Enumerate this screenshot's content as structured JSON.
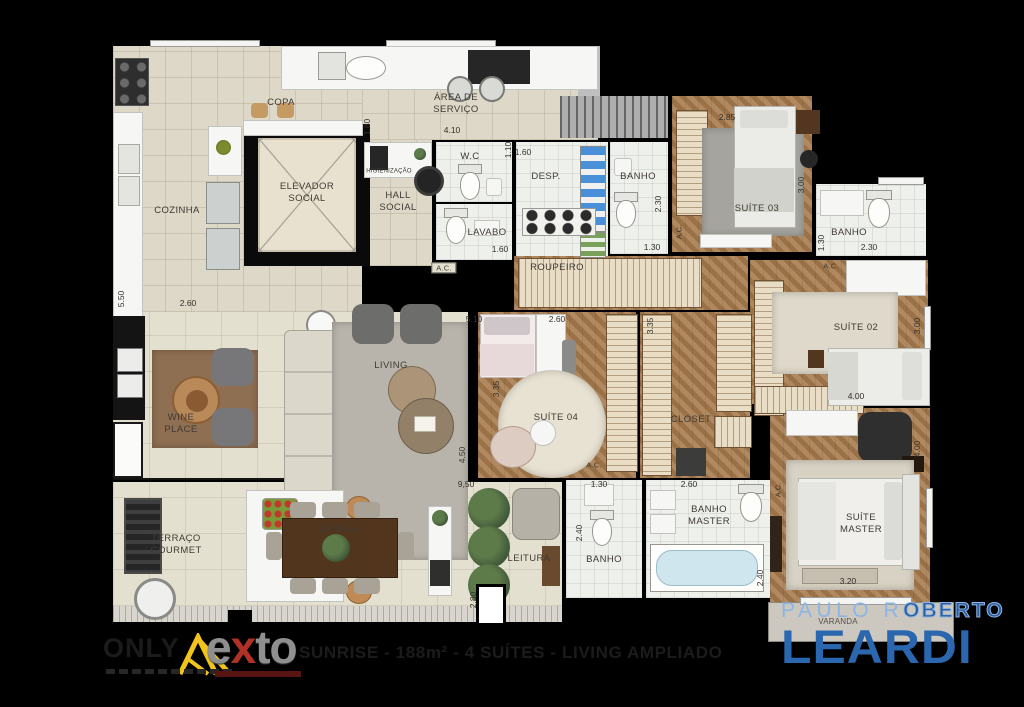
{
  "plan": {
    "rooms": {
      "copa": "COPA",
      "cozinha": "COZINHA",
      "area_servico": "ÁREA DE\nSERVIÇO",
      "elevador": "ELEVADOR\nSOCIAL",
      "higienizacao": "HIGIENIZAÇÃO",
      "hall": "HALL\nSOCIAL",
      "wc": "W.C",
      "lavabo": "LAVABO",
      "desp": "DESP.",
      "banho": "BANHO",
      "suite03": "SUÍTE 03",
      "roupeiro": "ROUPEIRO",
      "suite02": "SUÍTE 02",
      "suite04": "SUÍTE 04",
      "closet": "CLOSET",
      "wine": "WINE\nPLACE",
      "living": "LIVING",
      "terraco": "TERRAÇO\nGOURMET",
      "jantar": "JANTAR",
      "leitura": "LEITURA",
      "banho_master": "BANHO\nMASTER",
      "suite_master": "SUÍTE\nMASTER",
      "varanda": "VARANDA",
      "ac": "A.C."
    },
    "dims": {
      "d110": "1.10",
      "d130": "1.30",
      "d160": "1.60",
      "d180": "1.80",
      "d230": "2.30",
      "d240": "2.40",
      "d260": "2.60",
      "d280": "2.80",
      "d285": "2.85",
      "d300": "3.00",
      "d320": "3.20",
      "d335": "3.35",
      "d400": "4.00",
      "d410": "4.10",
      "d450": "4.50",
      "d510": "5.10",
      "d550": "5.50",
      "d950": "9,50"
    }
  },
  "footer": {
    "only_label": "ONLY",
    "exto_e": "e",
    "exto_x": "x",
    "exto_to": "to",
    "project_title": "SUNRISE - 188m² - 4 SUÍTES - LIVING AMPLIADO",
    "broker_line1a": "PAULO R",
    "broker_line1b": "OBERTO",
    "broker_line2": "LEARDI"
  }
}
